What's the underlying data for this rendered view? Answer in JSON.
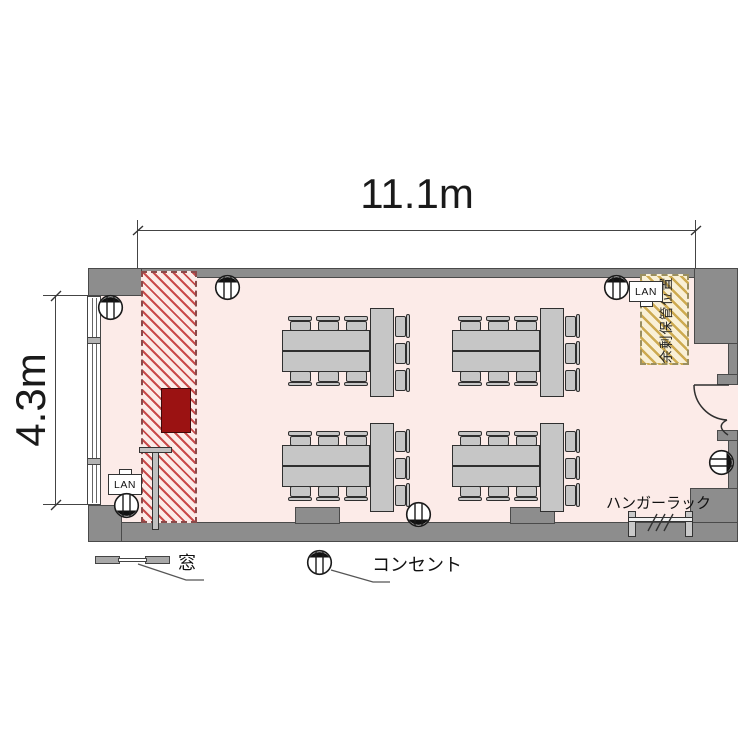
{
  "dimensions": {
    "width": "11.1m",
    "height": "4.3m"
  },
  "labels": {
    "lan": "LAN",
    "hanger_rack": "ハンガーラック"
  },
  "zones": {
    "storage": {
      "label": "余剰保管位置"
    },
    "presentation_area": {
      "style": "red-diagonal-hatch"
    }
  },
  "legend": {
    "window": "窓",
    "outlet": "コンセント"
  },
  "colors": {
    "wall": "#8d8d8d",
    "floor": "#fcebe8",
    "hatch_stripe": "#c94a4a",
    "podium": "#9b1212",
    "storage_fill": "#f9f0d6",
    "storage_stripe": "#cdaa50",
    "furniture": "#c6c6c6"
  },
  "furniture": {
    "group_composition": {
      "long_tables": 2,
      "end_table": 1,
      "chairs": 9
    },
    "table_groups": [
      {
        "x": 282,
        "y": 308
      },
      {
        "x": 452,
        "y": 308
      },
      {
        "x": 282,
        "y": 423
      },
      {
        "x": 452,
        "y": 423
      }
    ],
    "outlets": [
      {
        "x": 110,
        "y": 307,
        "dir": "top"
      },
      {
        "x": 227,
        "y": 287,
        "dir": "top"
      },
      {
        "x": 616,
        "y": 287,
        "dir": "top"
      },
      {
        "x": 126,
        "y": 505,
        "dir": "bottom"
      },
      {
        "x": 418,
        "y": 514,
        "dir": "bottom"
      },
      {
        "x": 721,
        "y": 462,
        "dir": "right"
      },
      {
        "x": 319,
        "y": 562,
        "dir": "top",
        "legend": true
      }
    ]
  }
}
